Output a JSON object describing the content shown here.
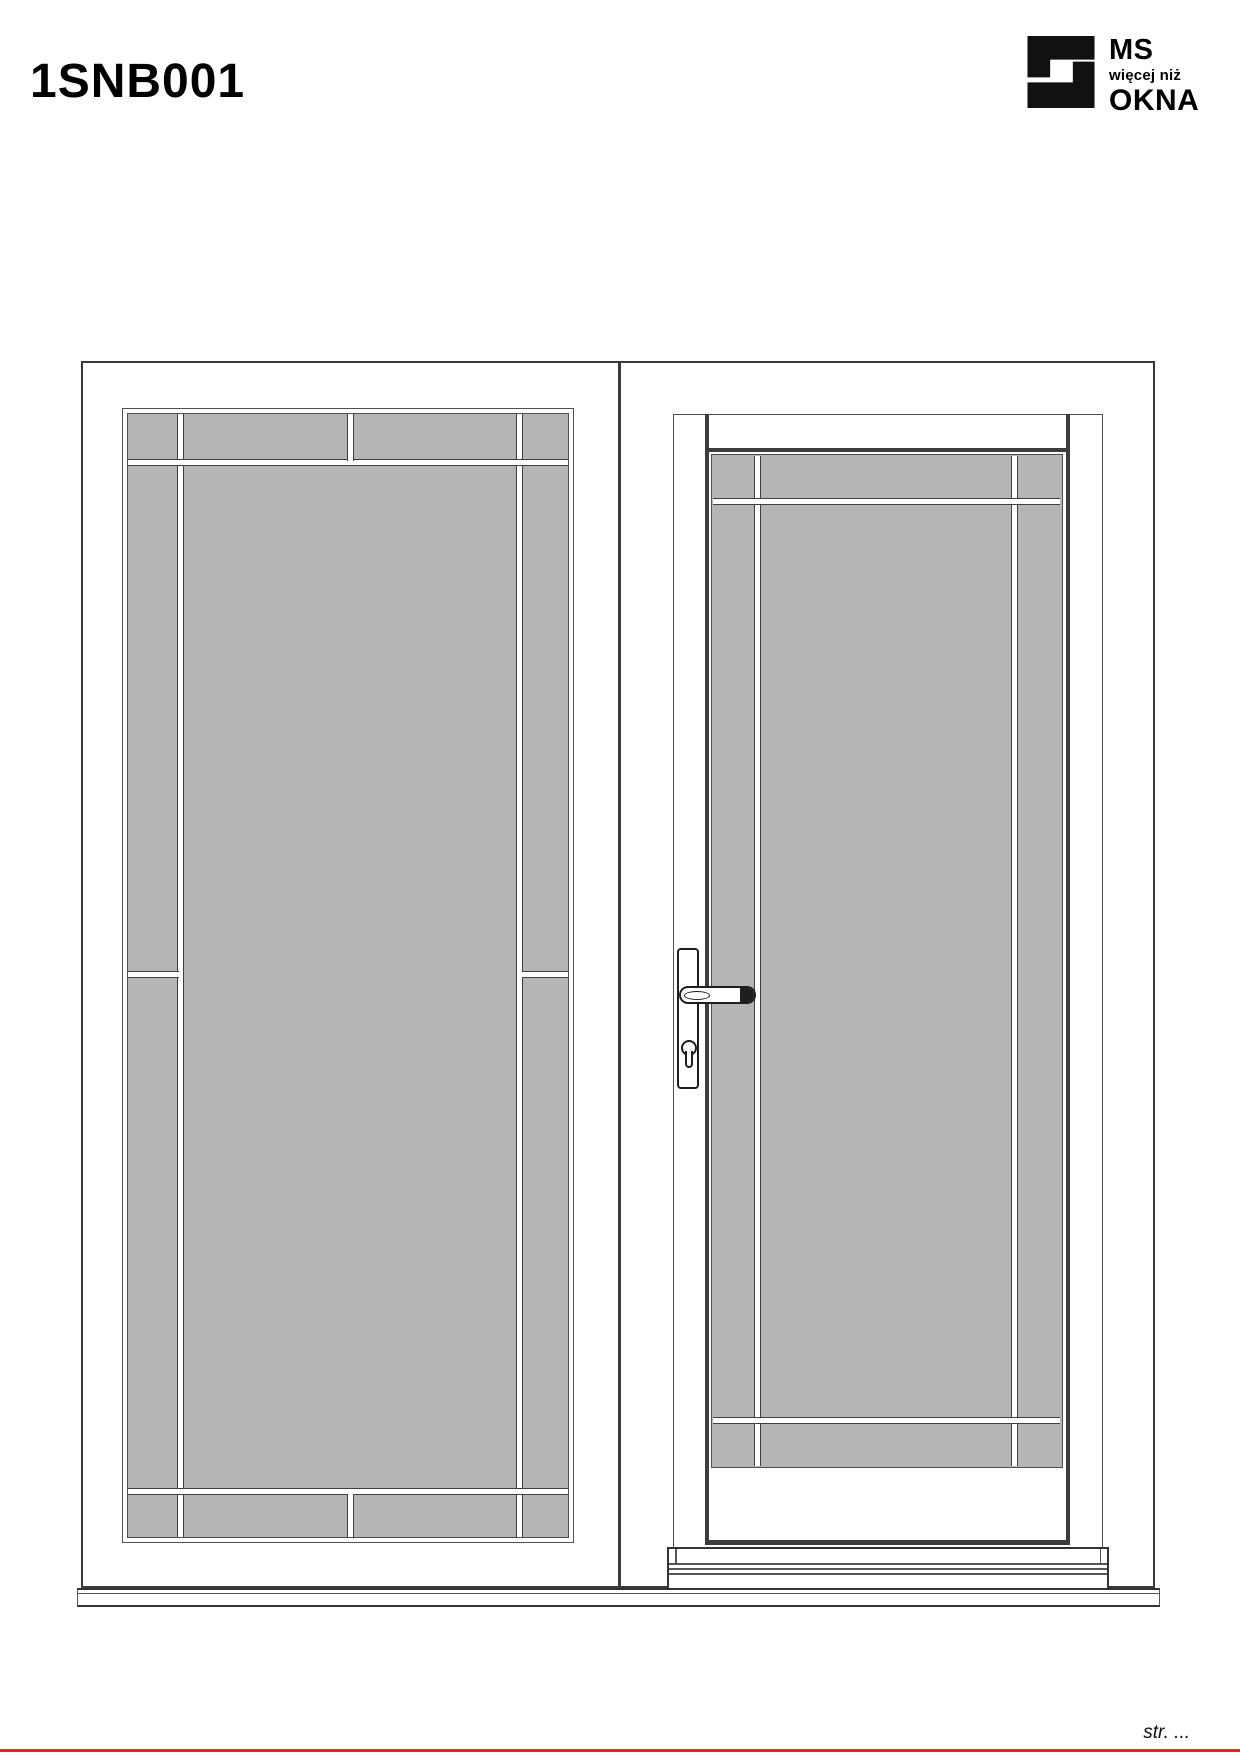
{
  "page": {
    "title": "1SNB001"
  },
  "logo": {
    "brand_top": "MS",
    "brand_middle": "więcej niż",
    "brand_bottom": "OKNA",
    "icon": "ms-okna-block-s-icon"
  },
  "footer": {
    "page_label": "str. ..."
  },
  "colors": {
    "glass_gray": "#b5b5b5",
    "outline_dark": "#3a3a3a",
    "outline_mid": "#4f4f4f",
    "leaf_gap_dark": "#3c3c3c",
    "handle_black": "#1e1e1e",
    "footer_rule_red": "#e5271f"
  }
}
